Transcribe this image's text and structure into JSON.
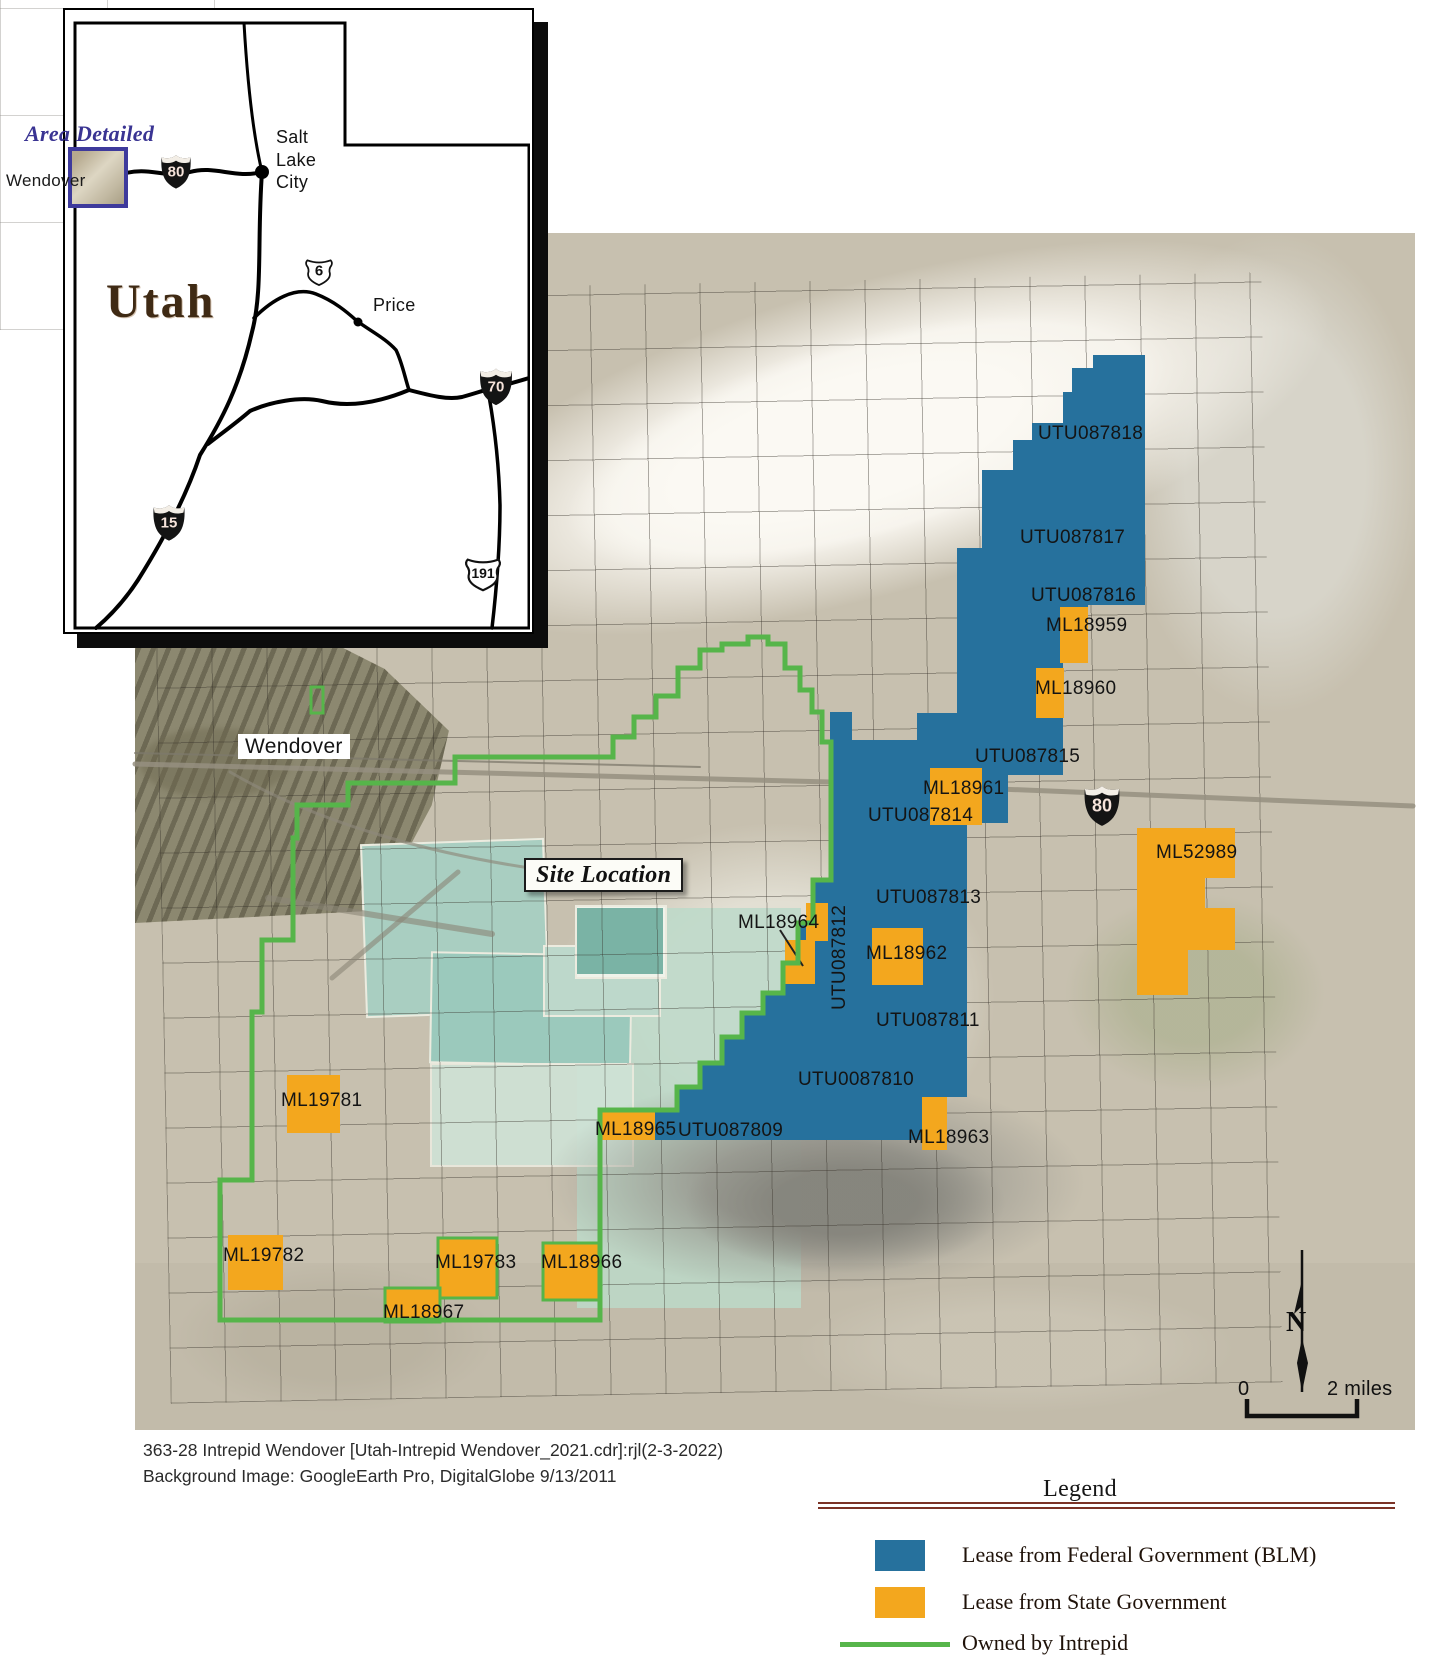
{
  "inset": {
    "area_detailed": "Area Detailed",
    "state_name": "Utah",
    "wendover": "Wendover",
    "salt_lake_city": "Salt Lake City",
    "price": "Price",
    "shields": {
      "i80": "80",
      "i15": "15",
      "i70": "70",
      "us6": "6",
      "us191": "191"
    }
  },
  "map": {
    "wendover_label": "Wendover",
    "site_location": "Site Location",
    "i80_shield": "80",
    "north_label": "N",
    "scale": {
      "start": "0",
      "end": "2 miles"
    },
    "federal_leases": [
      "UTU087818",
      "UTU087817",
      "UTU087816",
      "UTU087815",
      "UTU087814",
      "UTU087813",
      "UTU087812",
      "UTU087811",
      "UTU0087810",
      "UTU087809"
    ],
    "state_leases": {
      "ml18959": "ML18959",
      "ml18960": "ML18960",
      "ml18961": "ML18961",
      "ml52989": "ML52989",
      "ml18962": "ML18962",
      "ml18963": "ML18963",
      "ml18964": "ML18964",
      "ml18965": "ML18965",
      "ml18966": "ML18966",
      "ml18967": "ML18967",
      "ml19781": "ML19781",
      "ml19782": "ML19782",
      "ml19783": "ML19783"
    }
  },
  "caption": {
    "line1": "363-28 Intrepid Wendover [Utah-Intrepid Wendover_2021.cdr]:rjl(2-3-2022)",
    "line2": "Background Image:  GoogleEarth Pro, DigitalGlobe 9/13/2011"
  },
  "legend": {
    "title": "Legend",
    "items": [
      {
        "label": "Lease from Federal Government (BLM)",
        "color": "#26719d",
        "type": "swatch"
      },
      {
        "label": "Lease from State Government",
        "color": "#f3a71e",
        "type": "swatch"
      },
      {
        "label": "Owned by Intrepid",
        "color": "#56b54a",
        "type": "line"
      }
    ]
  },
  "colors": {
    "federal_blue": "#26719d",
    "state_orange": "#f3a71e",
    "intrepid_green": "#56b54a",
    "legend_rule_maroon": "#7b3226",
    "area_detailed_indigo": "#3a3493"
  }
}
